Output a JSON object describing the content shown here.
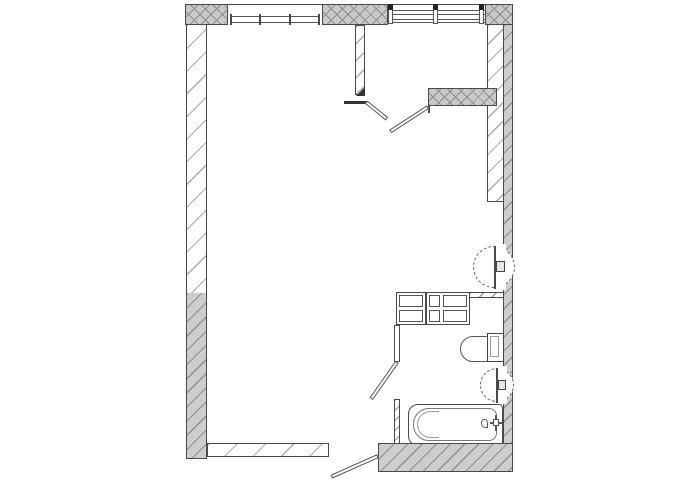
{
  "document": {
    "type": "architectural-floor-plan",
    "title": "Studio apartment floor plan (no text labels in drawing)"
  },
  "palette": {
    "background": "#ffffff",
    "line": "#4a4a4a",
    "bearing_wall_fill": "#c9c9c9",
    "bearing_wall_hatch": "#8e8e8e",
    "partition_hatch": "#ababab",
    "fixture_line": "#555555"
  },
  "rooms": [
    {
      "name": "main-room",
      "position": "left / centre"
    },
    {
      "name": "entrance-hall",
      "position": "top-right"
    },
    {
      "name": "bathroom",
      "position": "bottom-right"
    }
  ],
  "windows": [
    {
      "name": "window-left",
      "wall": "top",
      "style": "double-line sill with mullion ticks"
    },
    {
      "name": "window-right",
      "wall": "top",
      "style": "triple-line glazing with three posts"
    }
  ],
  "doors": [
    {
      "name": "hall-double-door",
      "state": "open",
      "swing": "into main room"
    },
    {
      "name": "bathroom-door",
      "state": "open",
      "swing": "into main room"
    },
    {
      "name": "bottom-door",
      "state": "open",
      "swing": "outward / down"
    }
  ],
  "fixtures": [
    {
      "name": "wash-basin-upper",
      "symbol": "dashed half-circle with tap"
    },
    {
      "name": "kitchen-cabinet-block",
      "symbol": "two-row rectangle grid"
    },
    {
      "name": "toilet",
      "symbol": "bowl with cistern on right wall"
    },
    {
      "name": "wash-basin-lower",
      "symbol": "dashed half-circle with tap"
    },
    {
      "name": "bathtub",
      "symbol": "rounded rectangle with taps, bottom-right"
    }
  ]
}
